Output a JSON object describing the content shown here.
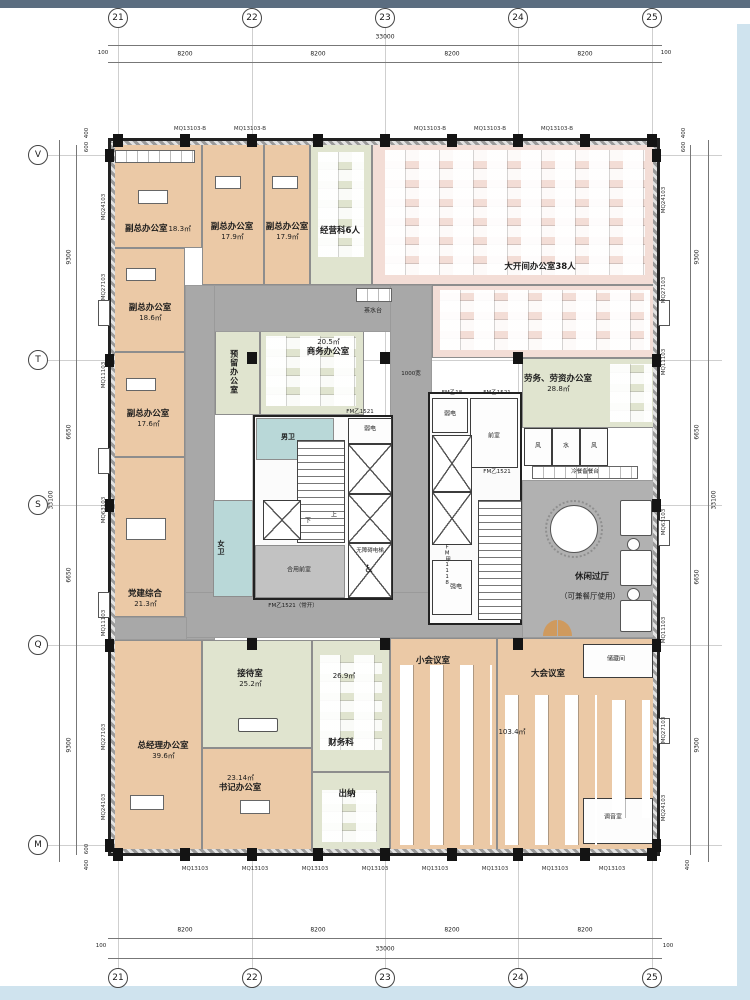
{
  "grid": {
    "cols": [
      "21",
      "22",
      "23",
      "24",
      "25"
    ],
    "rows": [
      "V",
      "T",
      "S",
      "Q",
      "M"
    ]
  },
  "dims": {
    "d8200": "8200",
    "d33000": "33000",
    "d100": "100",
    "d9300": "9300",
    "d6650": "6650",
    "d33100": "33100",
    "d600": "600",
    "d400": "400"
  },
  "window_tags": {
    "left": [
      "MQ24103",
      "MQ27103",
      "MQ11103",
      "MQ63103",
      "MQ11103",
      "MQ27103",
      "MQ24103"
    ],
    "right": [
      "MQ24103",
      "MQ27103",
      "MQ11103",
      "MQ63103",
      "MQ11103",
      "MQ27103",
      "MQ24103"
    ],
    "top": "MQ13103-B",
    "bottom": "MQ13103"
  },
  "rooms": [
    {
      "name": "副总办公室",
      "area": "18.3㎡"
    },
    {
      "name": "副总办公室",
      "area": "17.9㎡"
    },
    {
      "name": "副总办公室",
      "area": "17.9㎡"
    },
    {
      "name": "经营科6人",
      "area": ""
    },
    {
      "name": "大开间办公室38人",
      "area": ""
    },
    {
      "name": "副总办公室",
      "area": "18.6㎡"
    },
    {
      "name": "副总办公室",
      "area": "17.6㎡"
    },
    {
      "name": "党建综合",
      "area": "21.3㎡"
    },
    {
      "name": "总经理办公室",
      "area": "39.6㎡"
    },
    {
      "name": "接待室",
      "area": "25.2㎡"
    },
    {
      "name": "书记办公室",
      "area": "23.14㎡"
    },
    {
      "name": "预留办公室",
      "area": ""
    },
    {
      "name": "商务办公室",
      "area": "20.5㎡"
    },
    {
      "name": "劳务、劳资办公室",
      "area": "28.8㎡"
    },
    {
      "name": "休闲过厅",
      "sub": "（可兼餐厅使用）"
    },
    {
      "name": "财务科",
      "area": "26.9㎡"
    },
    {
      "name": "出纳",
      "area": ""
    },
    {
      "name": "小会议室",
      "area": ""
    },
    {
      "name": "大会议室",
      "area": "103.4㎡"
    },
    {
      "name": "储藏间",
      "area": ""
    },
    {
      "name": "调音室",
      "area": ""
    }
  ],
  "core_labels": {
    "tea": "茶水台",
    "male_wc": "男卫",
    "female_wc": "女卫",
    "weak_power": "弱电",
    "strong_power": "强电",
    "front_room": "前室",
    "shared_front_room": "合用前室",
    "accessible_lift": "无障碍电梯",
    "wheelchair": "♿",
    "water": "水",
    "air": "风",
    "buffet": "冷餐备餐台",
    "width1000": "1000宽",
    "up": "上",
    "down": "下",
    "fm_yi18": "FM乙18",
    "fm_yi1521": "FM乙1521",
    "fm_yi1521_no": "FM乙1521（常开）",
    "fm_jia1118": "FM甲1118"
  }
}
